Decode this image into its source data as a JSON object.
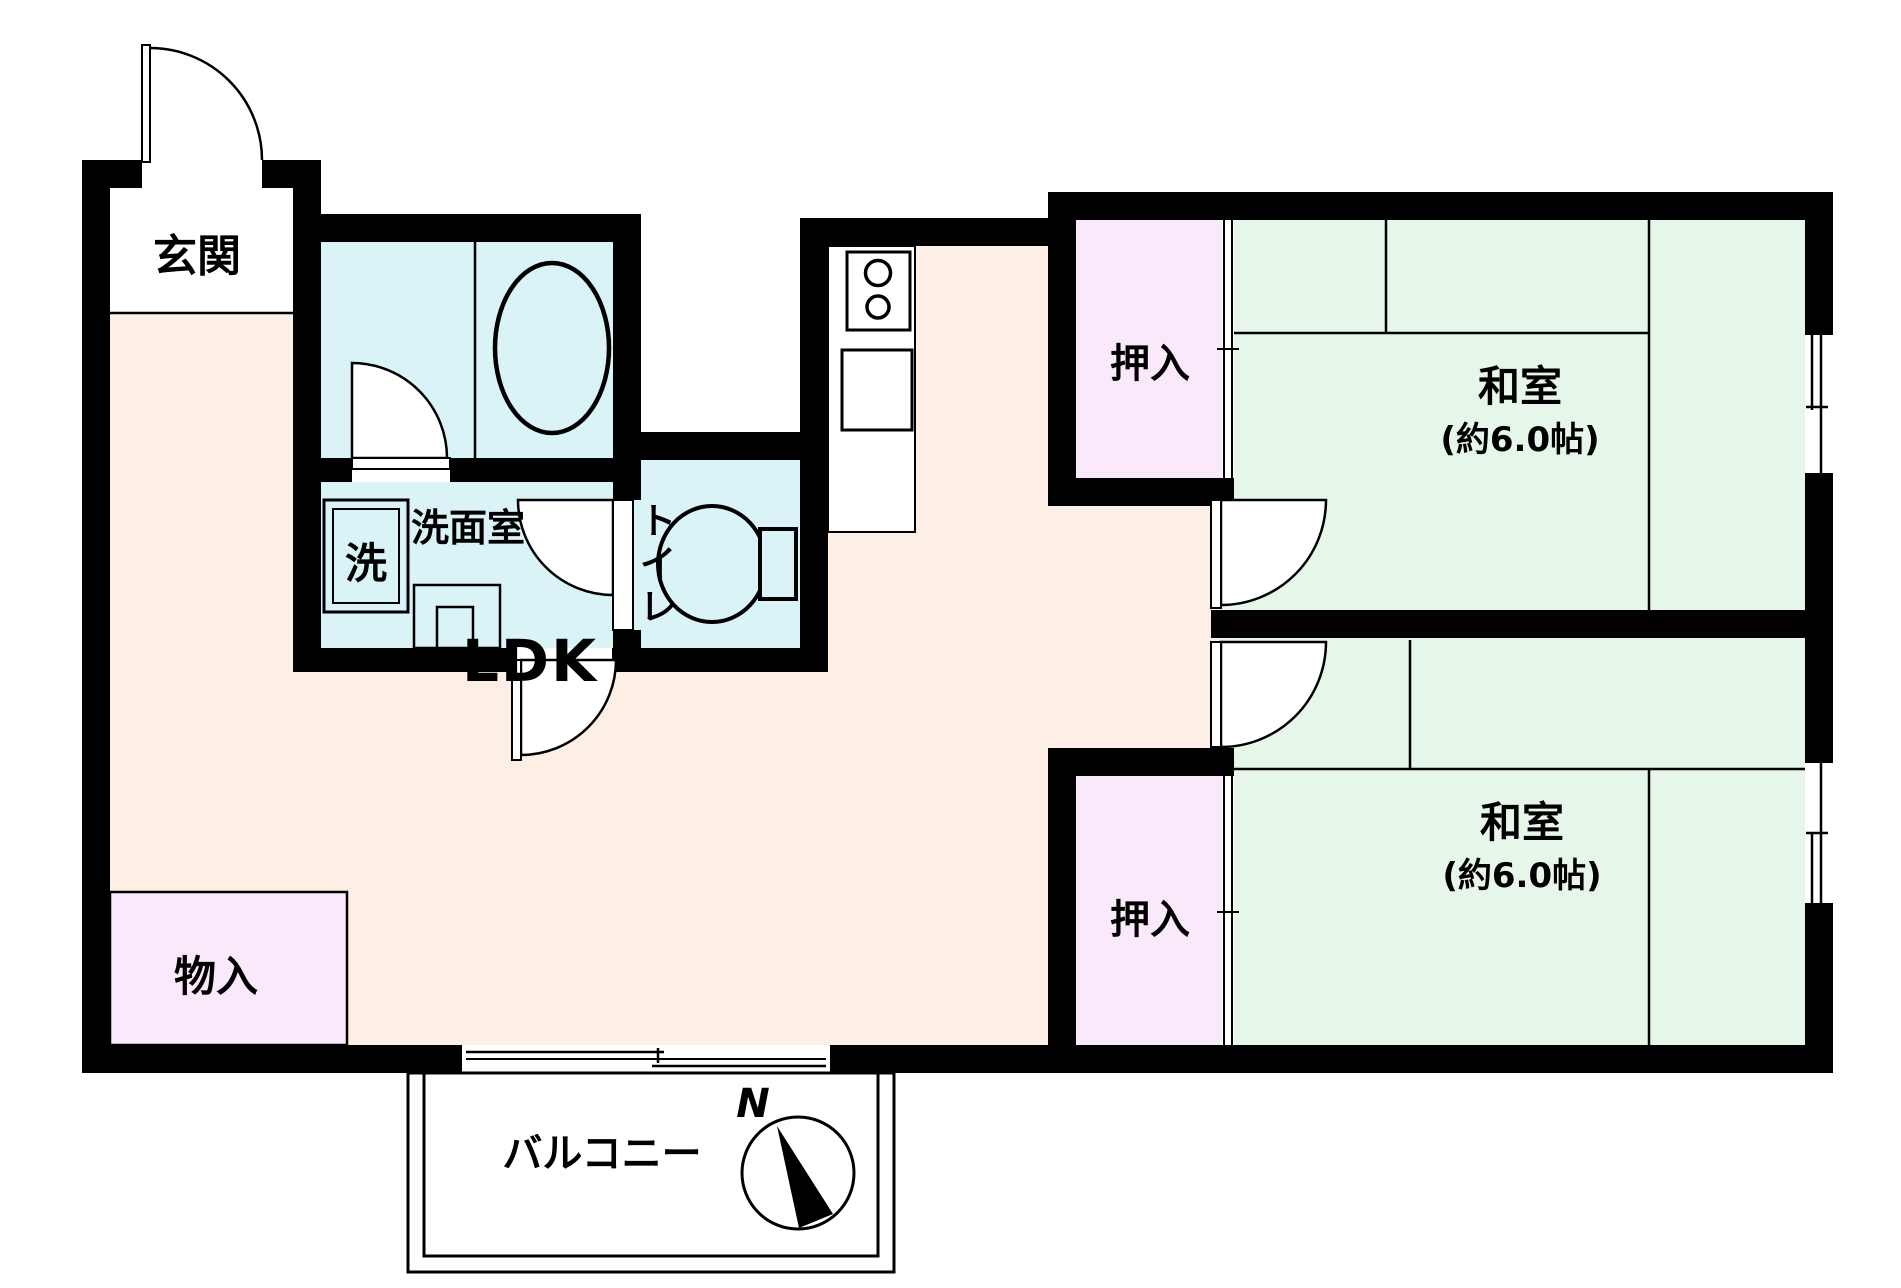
{
  "labels": {
    "genkan": "玄関",
    "ldk": "LDK",
    "monoire": "物入",
    "senmenshitsu": "洗面室",
    "laundry": "洗",
    "toilet": [
      "ト",
      "イ",
      "レ"
    ],
    "oshiire": "押入",
    "washitsu": "和室",
    "washitsu_size": "(約6.0帖)",
    "balcony": "バルコニー",
    "compass_n": "N"
  },
  "colors": {
    "wall": "#000000",
    "ldk_floor": "#fdeee6",
    "wet_area": "#d9f3f6",
    "tatami": "#e6f7ea",
    "closet": "#fae9fb",
    "exterior": "#ffffff"
  }
}
